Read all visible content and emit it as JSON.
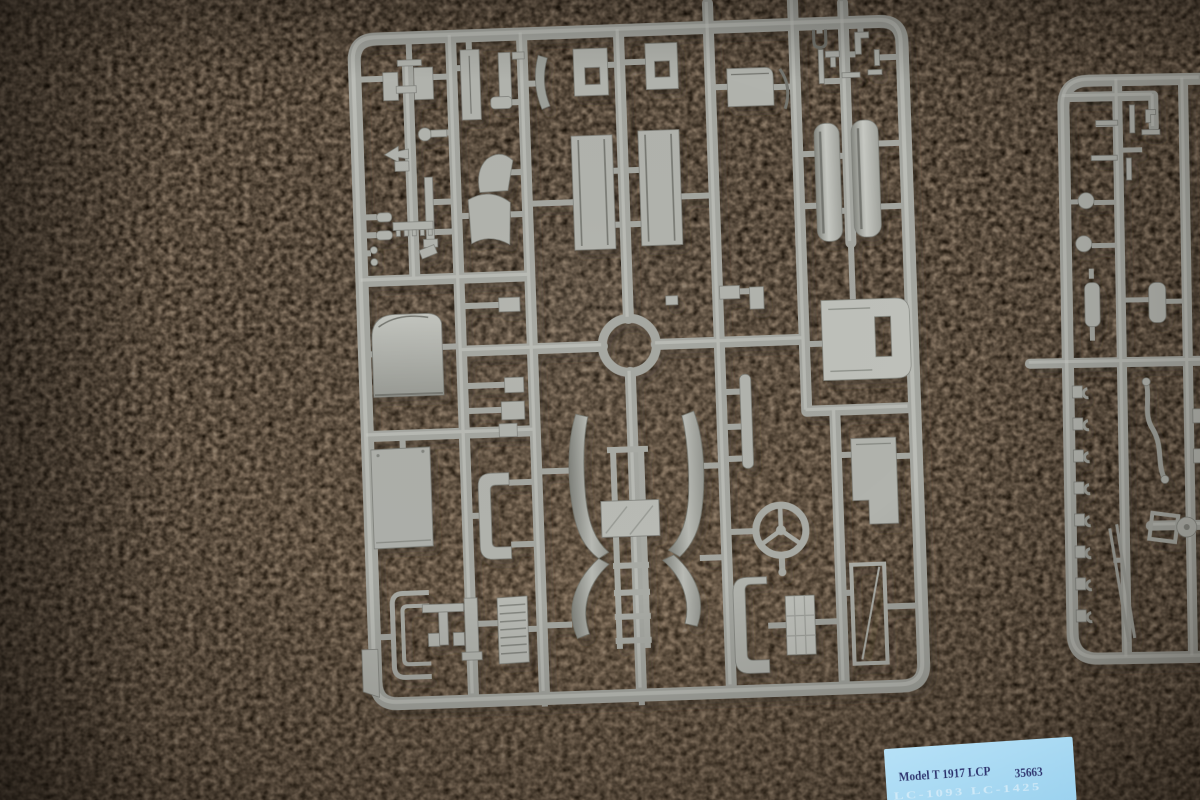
{
  "photo": {
    "subject": "Two grey injection-moulded styrene model-kit sprues photographed lying on a beige carpet",
    "kit": "Model T 1917 LCP"
  },
  "label": {
    "title": "Model T 1917 LCP",
    "kit_number": "35663",
    "watermark_line": "LC-1093 LC-1425",
    "paper_color": "#a9dbf5",
    "text_color": "#2b2f6d"
  },
  "colors": {
    "carpet_base": "#8f8275",
    "carpet_dark_fleck": "#5f564c",
    "carpet_light_fleck": "#a89b8b",
    "sprue_plastic": "#aaaca6",
    "sprue_highlight": "#c9cbc5",
    "sprue_shadow": "#7c7e78"
  },
  "sprues": {
    "main": {
      "name": "main-sprue",
      "parts": [
        "hood-panel",
        "radiator-shell",
        "chassis-rail-left",
        "chassis-rail-right",
        "window-frame-panel-left",
        "window-frame-panel-right",
        "front-fender-strip-left",
        "front-fender-strip-right",
        "seat-back",
        "seat-cushion",
        "steering-wheel",
        "steering-column",
        "windshield-frame",
        "rear-body-with-fenders",
        "running-board-ladder",
        "louvered-side-panel",
        "floor-panel",
        "u-channel-rails",
        "c-bracket-left",
        "c-bracket-right",
        "checkered-plate",
        "corner-wedge",
        "assorted-small-brackets"
      ]
    },
    "right": {
      "name": "right-sprue-partial",
      "parts": [
        "headlamp-ball",
        "headlamp-ball",
        "tank-cylinder",
        "tank-cylinder",
        "tow-hook-row",
        "bent-axle-rod",
        "pulley-disc",
        "thin-rods",
        "small-clips"
      ]
    }
  }
}
